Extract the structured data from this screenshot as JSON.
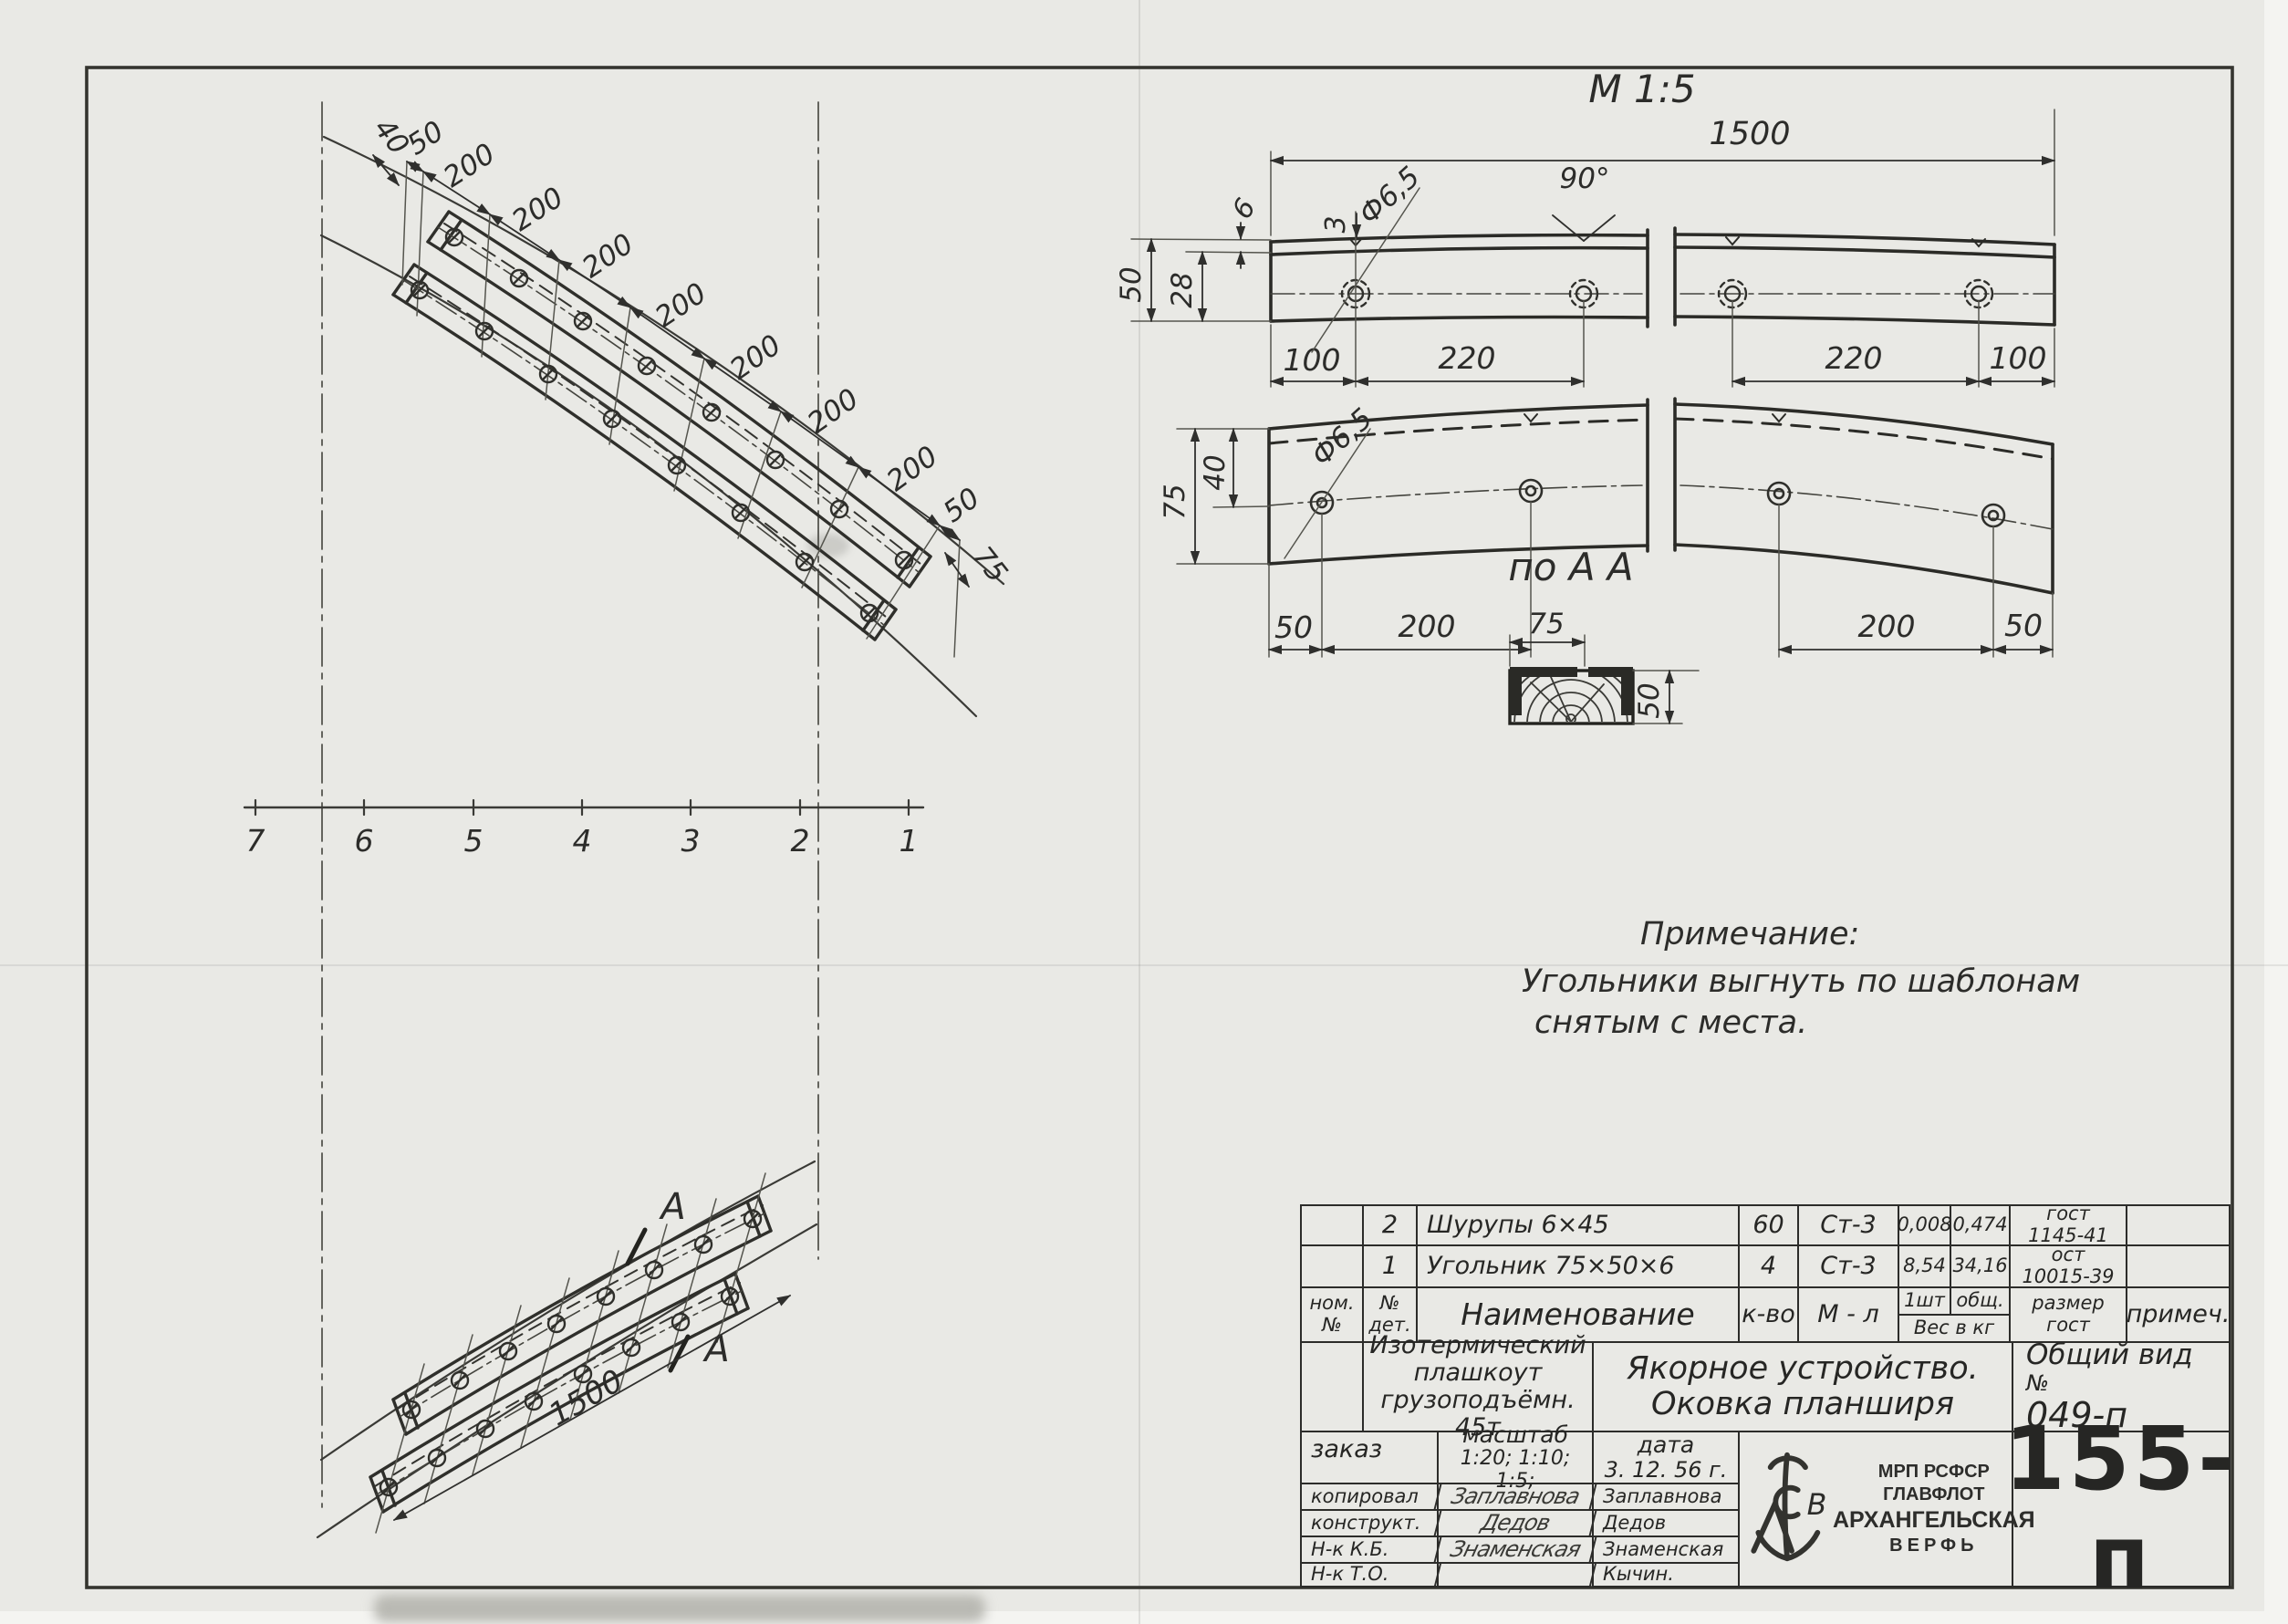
{
  "top_left": {
    "dim40": "40",
    "chain": [
      "50",
      "200",
      "200",
      "200",
      "200",
      "200",
      "200",
      "200",
      "50"
    ],
    "dim75": "75",
    "stations": [
      "7",
      "6",
      "5",
      "4",
      "3",
      "2",
      "1"
    ]
  },
  "bottom_left": {
    "dim1500": "1500",
    "a": "А"
  },
  "top_right": {
    "scale": "M 1:5",
    "len": "1500",
    "d3": "3",
    "dia": "Ф6,5",
    "ang": "90°",
    "d50": "50",
    "d28": "28",
    "d6": "6",
    "top_dims": [
      "100",
      "220",
      "220",
      "100"
    ],
    "d75": "75",
    "d40": "40",
    "dia2": "Ф6,5",
    "bot_dims": [
      "50",
      "200",
      "200",
      "50"
    ]
  },
  "section": {
    "label": "по А А",
    "w": "75",
    "h": "50"
  },
  "note": {
    "title": "Примечание:",
    "line1": "Угольники выгнуть по шаблонам",
    "line2": "снятым с места."
  },
  "parts": {
    "rows": [
      {
        "no": "2",
        "name": "Шурупы  6×45",
        "qty": "60",
        "mat": "Ст-3",
        "w1": "0,008",
        "w2": "0,474",
        "std1": "гост",
        "std2": "1145-41",
        "rem": ""
      },
      {
        "no": "1",
        "name": "Угольник  75×50×6",
        "qty": "4",
        "mat": "Ст-3",
        "w1": "8,54",
        "w2": "34,16",
        "std1": "ост",
        "std2": "10015-39",
        "rem": ""
      }
    ],
    "hdr": {
      "c1a": "ном.",
      "c1b": "№",
      "c2a": "№",
      "c2b": "дет.",
      "name": "Наименование",
      "qty": "к-во",
      "mat": "М - л",
      "w1": "1шт",
      "w2": "общ.",
      "wt": "Вес в кг",
      "std1": "размер",
      "std2": "гост",
      "note": "примеч."
    }
  },
  "title_block": {
    "proj1": "Изотермический",
    "proj2": "плашкоут",
    "proj3": "грузоподъёмн. 45т",
    "t1": "Якорное  устройство.",
    "t2": "Оковка  планширя",
    "view": "Общий вид",
    "no_label": "№",
    "no": "049-п"
  },
  "approval": {
    "order": "заказ",
    "scale_label": "масштаб",
    "scale": "1:20; 1:10; 1:5;",
    "date_label": "дата",
    "date": "3. 12. 56 г.",
    "rows": [
      {
        "label": "копировал",
        "sig": "Заплавнова",
        "name": "Заплавнова"
      },
      {
        "label": "конструкт.",
        "sig": "Дедов",
        "name": "Дедов"
      },
      {
        "label": "Н-к  К.Б.",
        "sig": "Знаменская",
        "name": "Знаменская"
      },
      {
        "label": "Н-к  Т.О.",
        "sig": "",
        "name": "Кычин."
      }
    ]
  },
  "stamp": {
    "l1": "МРП РСФСР",
    "l2": "ГЛАВФЛОТ",
    "l3": "АРХАНГЕЛЬСКАЯ",
    "l4": "ВЕРФЬ",
    "number": "155-п"
  }
}
